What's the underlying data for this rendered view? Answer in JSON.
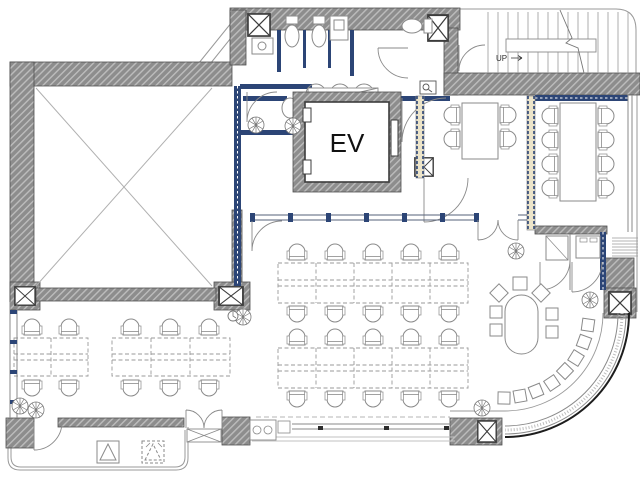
{
  "title": "office-floor-plan",
  "labels": {
    "elevator": "EV",
    "stairs_direction": "UP"
  },
  "colors": {
    "background": "#ffffff",
    "wall_gray": "#8d8d8d",
    "wall_hatch": "#bdbdbd",
    "partition_navy": "#2c4576",
    "partition_tan": "#ece4c9",
    "drawing_line": "#8a8a8a",
    "curtain_wall_black": "#1d1d1d"
  },
  "rooms": {
    "void_room_with_cross_brace": 1,
    "elevator_shaft": 1,
    "stair_hall": 1,
    "toilet_stalls": 3,
    "sink_units": 2,
    "meeting_room_small": 1,
    "meeting_room_large": 1,
    "pantry_storage_rooms": 2,
    "open_office": 1,
    "left_office": 1,
    "lounge_with_curved_window": 1,
    "terrace": 1
  },
  "furniture": {
    "open_office_bench_rows": 2,
    "seats_per_bench_row": 10,
    "left_office_benches": [
      {
        "seats": 4
      },
      {
        "seats": 6
      }
    ],
    "meeting_room_small_seats": 4,
    "meeting_room_large_seats": 8,
    "lounge_oval_table_seats": 7,
    "curved_counter_seats": 8,
    "plants": 8,
    "structural_x_columns": 7,
    "terrace_equipment_units": 2
  }
}
